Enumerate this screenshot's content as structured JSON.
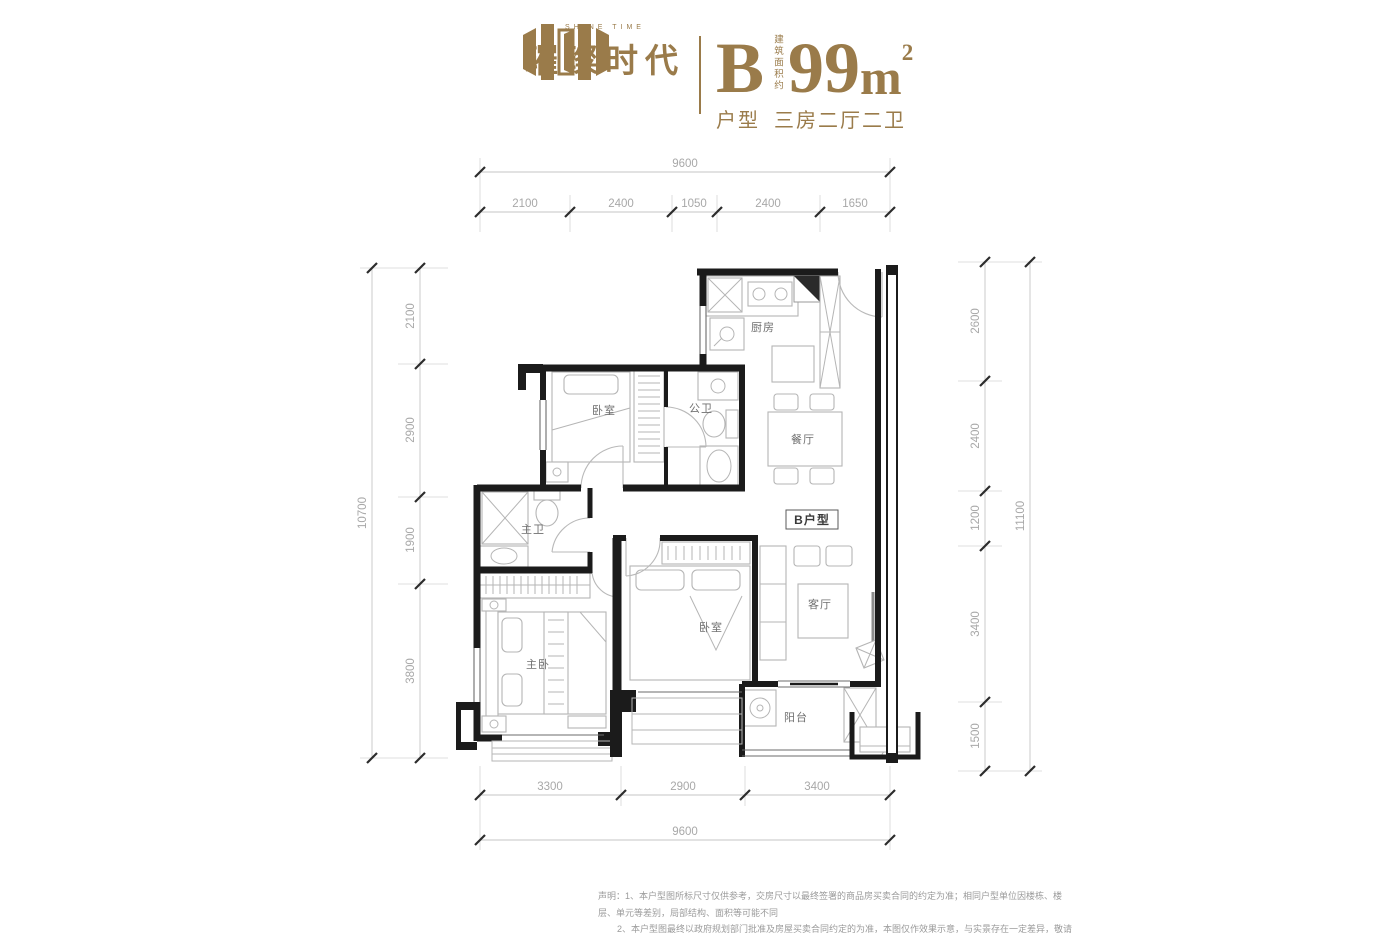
{
  "header": {
    "brand_name": "璀璨时代",
    "brand_subtitle": "SHINE TIME",
    "unit_letter": "B",
    "area_note": "建筑面积约",
    "area_value": "99",
    "area_unit": "m",
    "area_sup": "2",
    "type_label": "户型",
    "type_value": "三房二厅二卫"
  },
  "plan": {
    "rooms": {
      "kitchen": "厨房",
      "bedroom1": "卧室",
      "public_bath": "公卫",
      "dining": "餐厅",
      "master_bath": "主卫",
      "master_bedroom": "主卧",
      "bedroom2": "卧室",
      "living": "客厅",
      "balcony": "阳台",
      "unit_tag": "B户型"
    },
    "dimensions": {
      "top": {
        "total": "9600",
        "segments": [
          "2100",
          "2400",
          "1050",
          "2400",
          "1650"
        ]
      },
      "bottom": {
        "total": "9600",
        "segments": [
          "3300",
          "2900",
          "3400"
        ]
      },
      "left": {
        "total": "10700",
        "segments": [
          "2100",
          "2900",
          "1900",
          "3800"
        ]
      },
      "right": {
        "total": "11100",
        "segments": [
          "2600",
          "2400",
          "1200",
          "3400",
          "1500"
        ]
      }
    }
  },
  "disclaimer": {
    "line1": "声明：1、本户型图所标尺寸仅供参考，交房尺寸以最终签署的商品房买卖合同的约定为准；相同户型单位因楼栋、楼层、单元等差别，局部结构、面积等可能不同",
    "line2": "2、本户型图最终以政府规划部门批准及房屋买卖合同约定的为准，本图仅作效果示意，与实景存在一定差异，敬请注意"
  },
  "colors": {
    "brand_gold": "#9a7b4a",
    "wall_black": "#1b1b1b",
    "furniture_gray": "#b5b5b5",
    "dimension_gray": "#a8a8a8"
  }
}
